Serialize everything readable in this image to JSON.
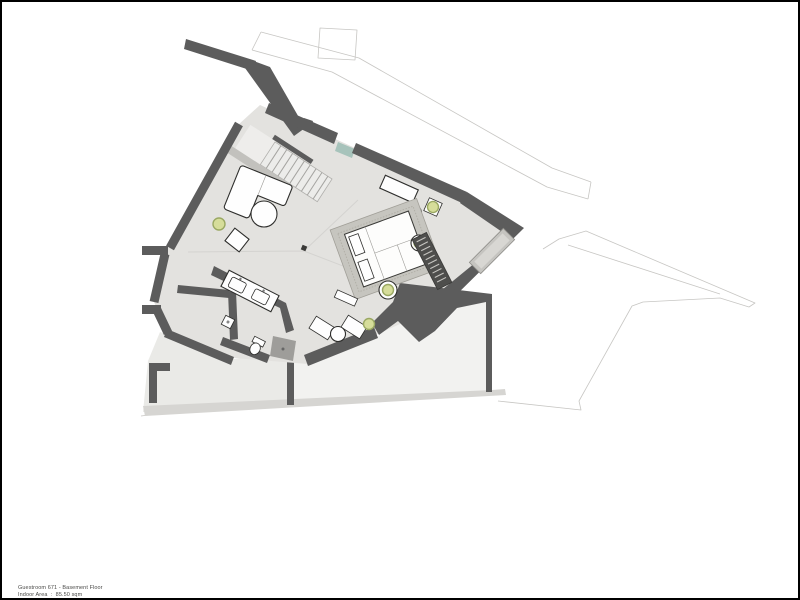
{
  "caption": {
    "line1": "Guestroom 671 - Basement Floor",
    "line2": "Indoor Area  :  85.50 sqm"
  },
  "colors": {
    "frame": "#000000",
    "wall": "#5c5c5c",
    "floor": "#e3e2df",
    "floor_seam": "#d4d3d0",
    "terrace_left": "#eaeae7",
    "terrace_right": "#f2f2f0",
    "deck_band": "#d6d5d2",
    "outline": "#c7c6c3",
    "furniture_fill": "#fefefe",
    "furniture_stroke": "#2e2e2c",
    "bed_border": "#c6c5bf",
    "ladder": "#4e4e4c",
    "ladder_rung": "#c6c5c1",
    "closet": "#c5c4c0",
    "closet_inner": "#d8d7d3",
    "parapet": "#c2c1bd",
    "stair_tread": "#ececea",
    "stair_edge": "#b0afac",
    "stair_tread_line": "#a5a4a1",
    "glass": "#a7c3bb",
    "plant_fill": "#d6dd9a",
    "plant_ring": "#9aa862",
    "shower": "#9e9d9a",
    "column": "#3a3a38",
    "caption_text": "#4a4a48"
  }
}
